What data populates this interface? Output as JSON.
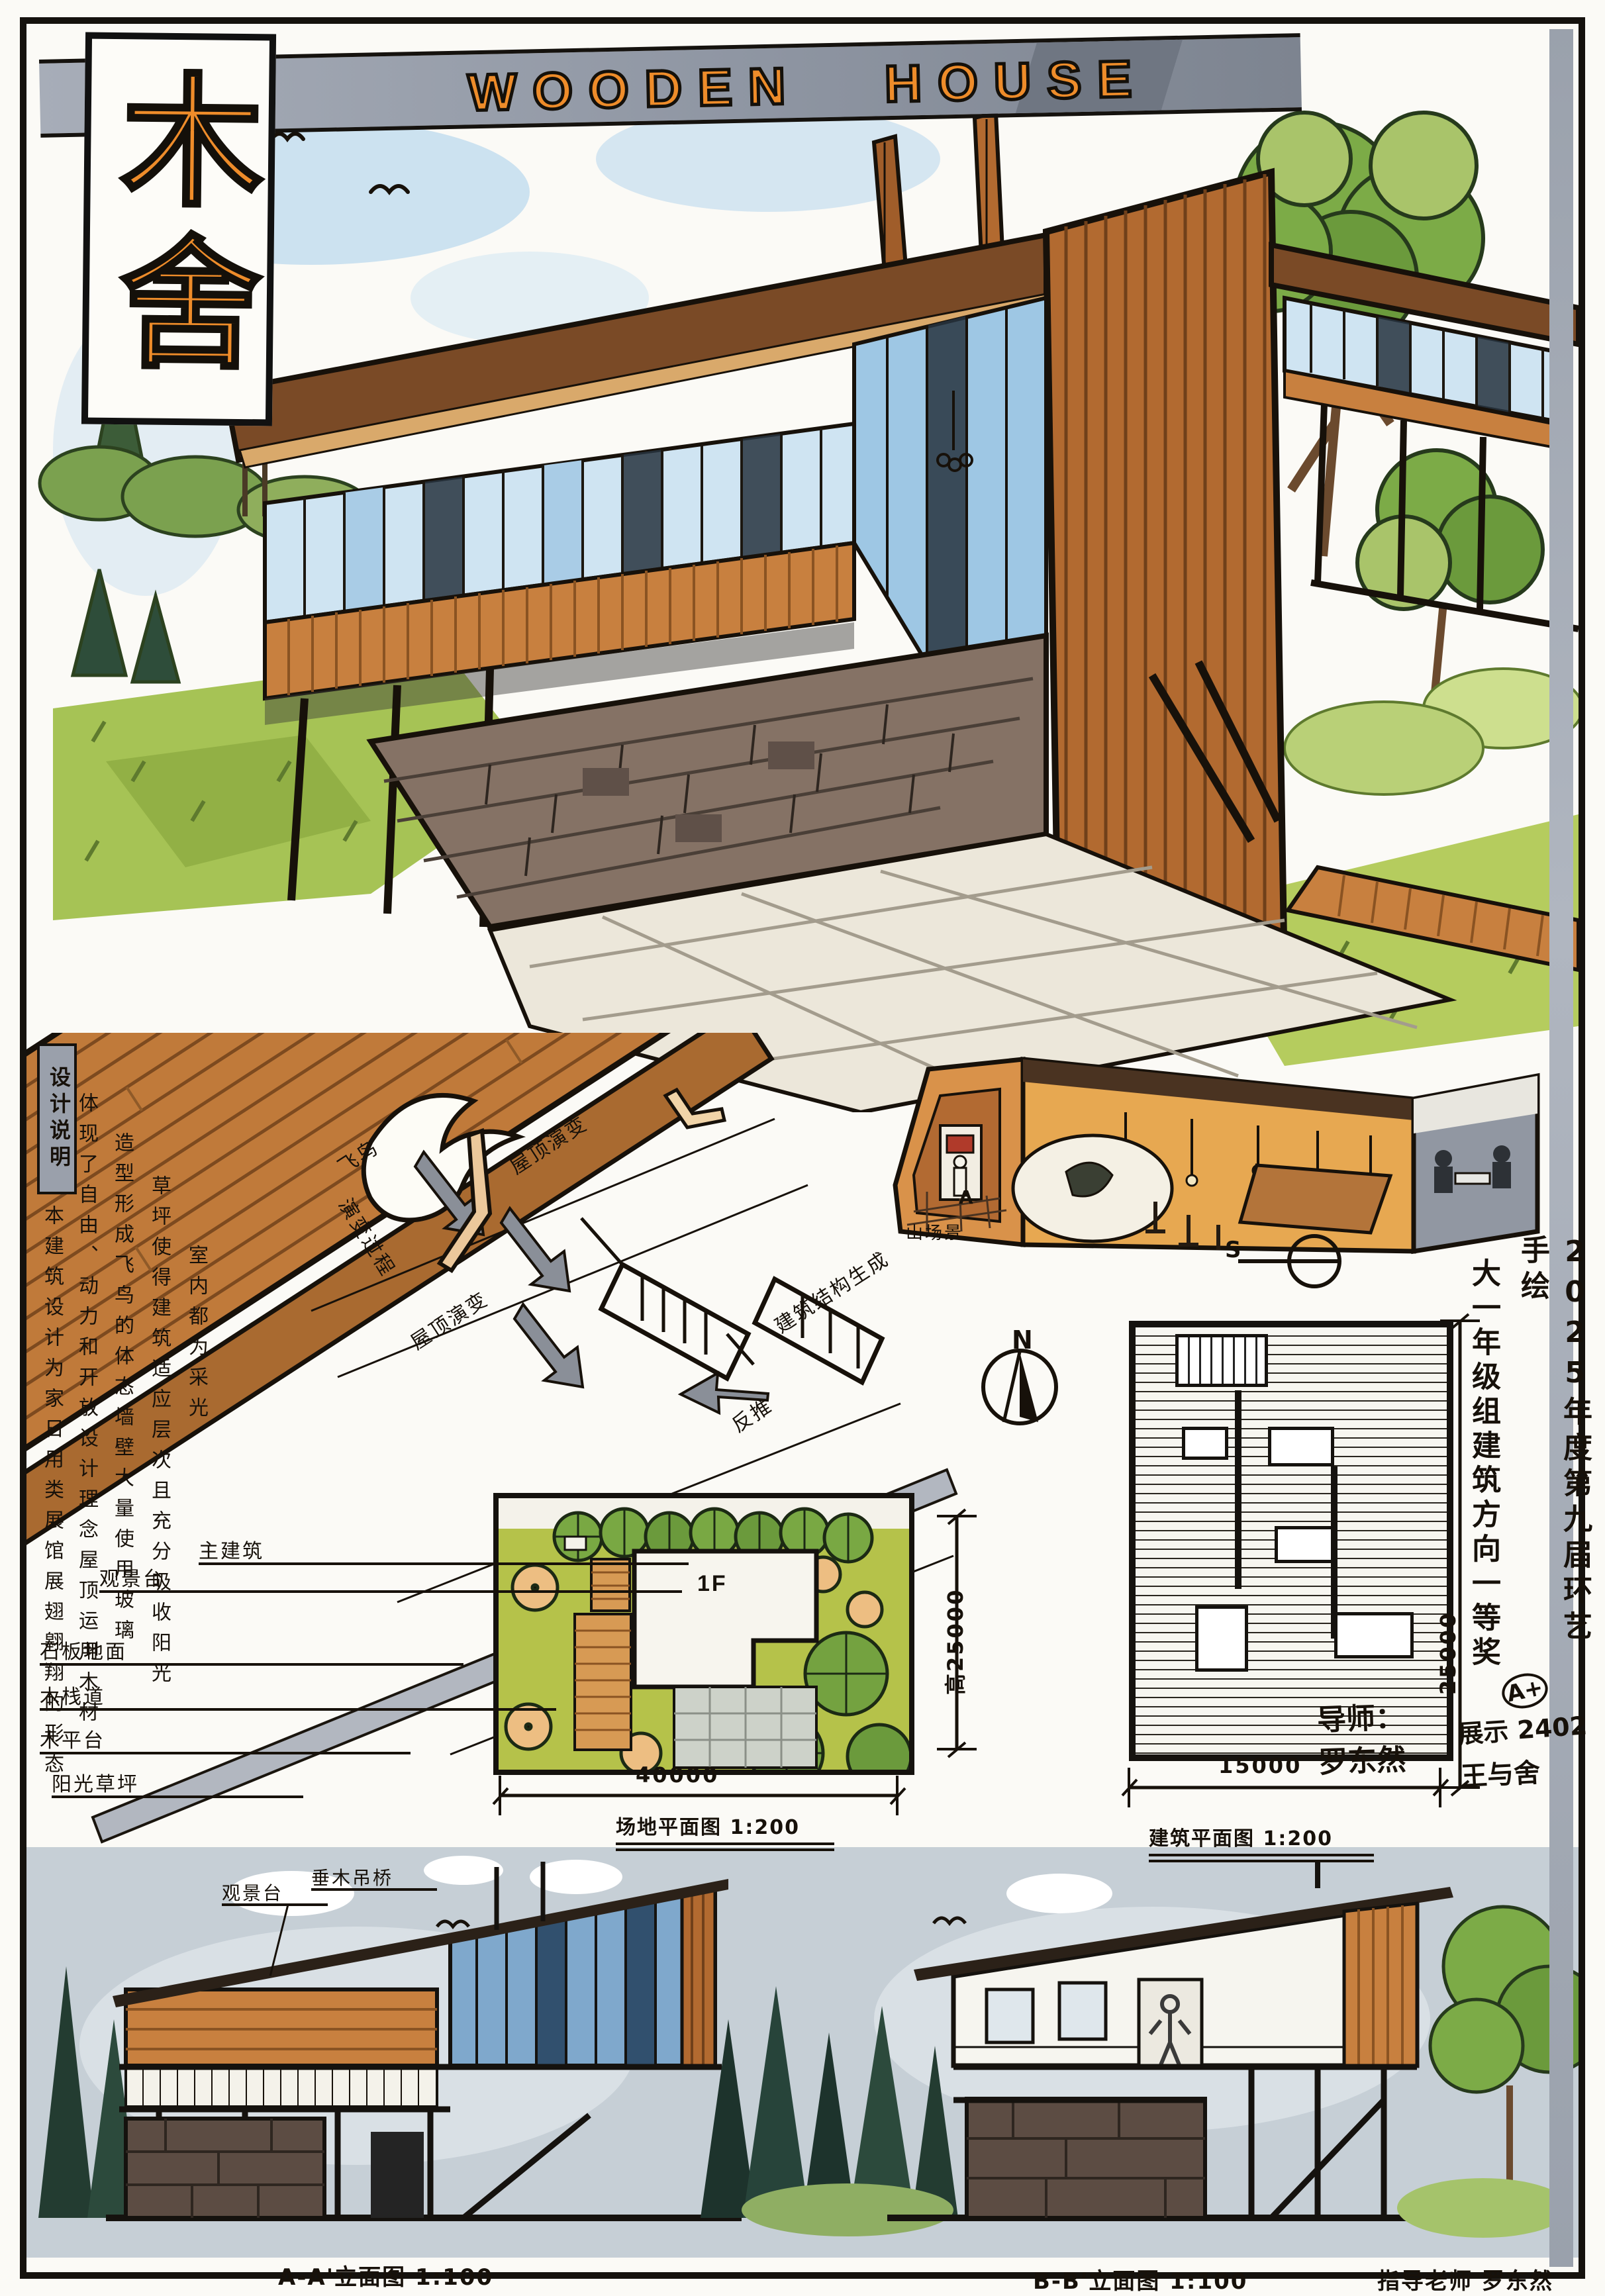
{
  "board": {
    "title_en": "WOODEN HOUSE",
    "title_cn": "木舍",
    "tutor_caption": "指导老师 罗东然"
  },
  "award": {
    "column_right": "2025年度第九届环艺手绘",
    "grade_mark": "A+",
    "column_left": "大一年级组建筑方向一等奖",
    "class_line": "展示 2402",
    "name_line": "王与舍"
  },
  "design_notes": {
    "header": "设计说明",
    "columns": [
      "本建筑设计为家日用类展馆展翅翱翔的形态",
      "体现了自由、动力和开放设计理念屋顶运用木材",
      "造型形成飞鸟的体态墙壁大量使用玻璃",
      "草坪使得建筑适应层次且充分吸收阳光",
      "室内都为采光"
    ]
  },
  "callouts": {
    "items": [
      "主建筑",
      "观景台",
      "石板地面",
      "木栈道",
      "木平台",
      "阳光草坪"
    ]
  },
  "concept": {
    "bird": "飞鸟",
    "process": "演变过程",
    "roof_evolution_1": "屋顶演变",
    "roof_evolution_2": "屋顶演变",
    "structure": "建筑结构生成",
    "reverse": "反推"
  },
  "interior": {
    "scene_label": "山场景",
    "floor_marker": "A",
    "compass_s": "S"
  },
  "site_plan": {
    "caption": "场地平面图 1:200",
    "width_dim": "40000",
    "height_dim": "高25000",
    "floor_label": "1F",
    "north_label": "N"
  },
  "floor_plan": {
    "caption": "建筑平面图 1:200",
    "width_dim": "15000",
    "height_dim": "25000",
    "mentor_line1": "导师：",
    "mentor_line2": "罗东然"
  },
  "elevations": {
    "a_caption": "A-A'立面图 1:100",
    "b_caption": "B-B'立面图 1:100",
    "label_top": "垂木吊桥",
    "label_deck": "观景台"
  },
  "colors": {
    "accent_orange": "#ee8c2a",
    "wood": "#c8803f",
    "wood_dark": "#8a5322",
    "roof": "#7a4a26",
    "glass": "#cfe4f2",
    "glass_dark": "#273440",
    "stone": "#857265",
    "lawn": "#b5c24a",
    "tree_green": "#7cab47",
    "banner_gray": "#a3a9b4",
    "sky": "#bcd9ee",
    "pine_dark": "#27413a",
    "wash_blue": "#c6cfd6",
    "ink": "#17110a"
  }
}
